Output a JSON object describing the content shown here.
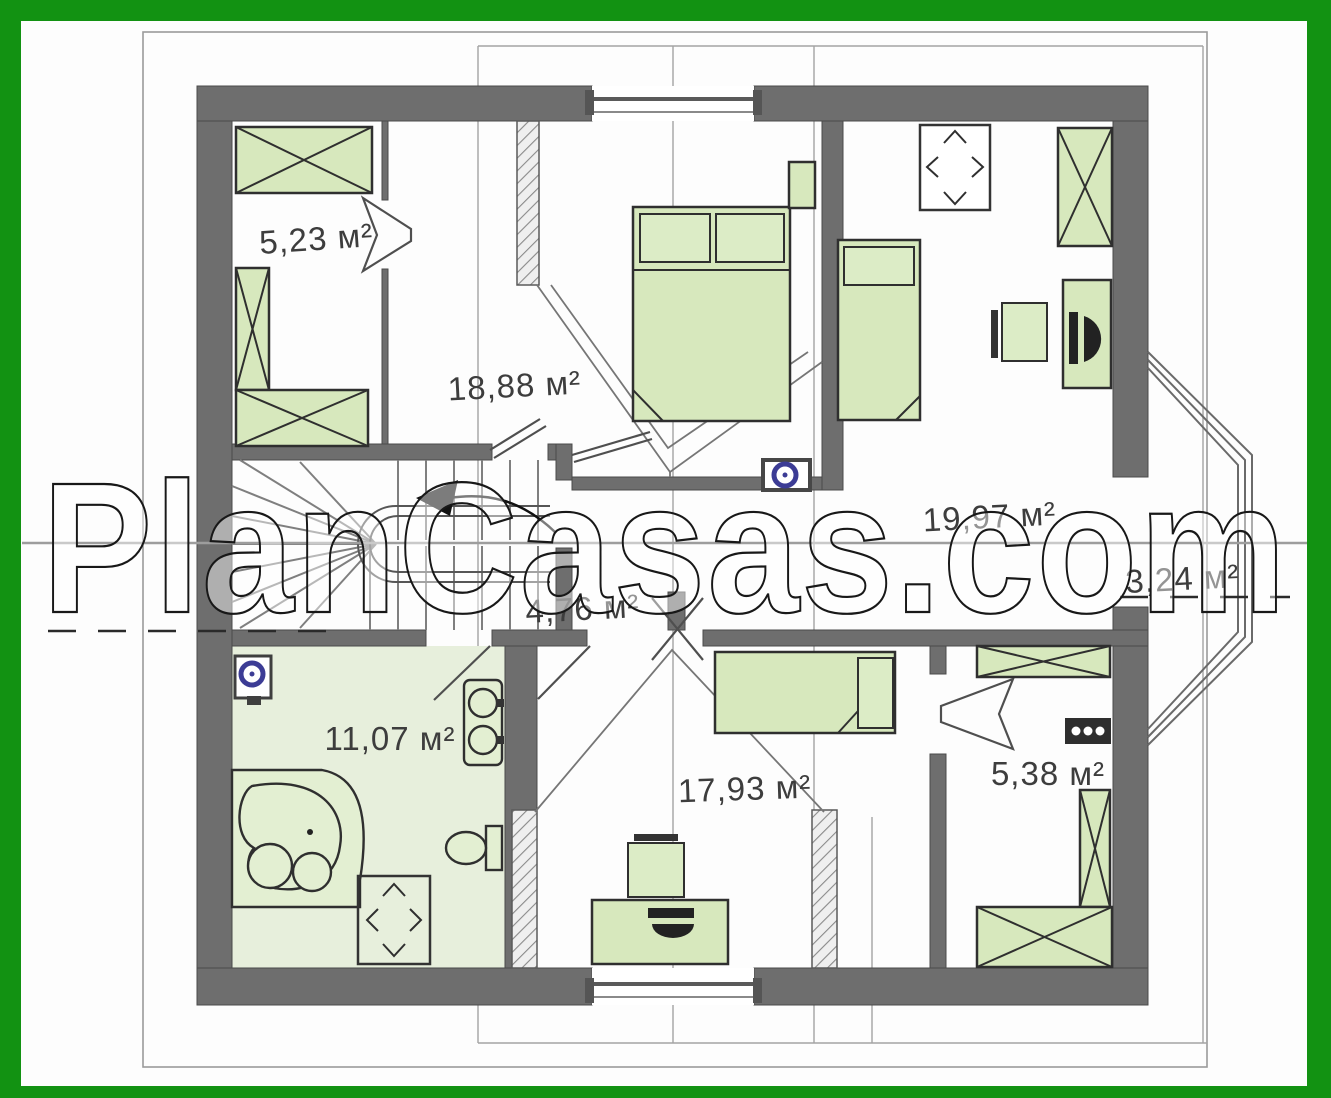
{
  "watermark": {
    "text": "PlanCasas.com"
  },
  "rooms": [
    {
      "name": "wardrobe-upper",
      "area_label": "5,23 м²"
    },
    {
      "name": "bedroom-main",
      "area_label": "18,88 м²"
    },
    {
      "name": "bedroom-right",
      "area_label": "19,97 м²"
    },
    {
      "name": "bay-alcove",
      "area_label": "3,24 м²"
    },
    {
      "name": "hallway",
      "area_label": "4,76 м²"
    },
    {
      "name": "bathroom",
      "area_label": "11,07 м²"
    },
    {
      "name": "bedroom-lower",
      "area_label": "17,93 м²"
    },
    {
      "name": "wardrobe-lower",
      "area_label": "5,38 м²"
    }
  ],
  "colors": {
    "frame_green": "#129212",
    "wall_gray": "#6e6e6e",
    "furniture_green": "#d7e8bd",
    "floor_tint": "#e7efdc",
    "vent_blue": "#3c3c95"
  }
}
